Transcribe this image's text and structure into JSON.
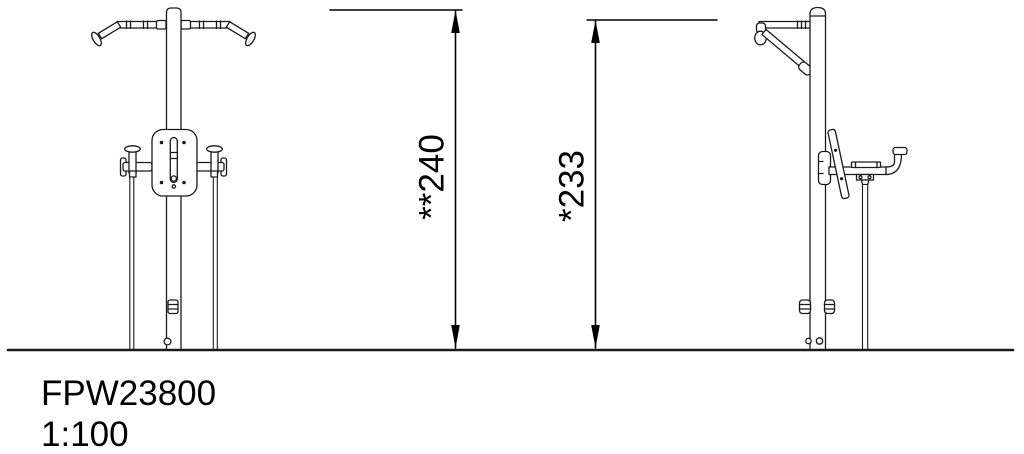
{
  "drawing": {
    "title_block": {
      "product_code": "FPW23800",
      "scale": "1:100"
    },
    "dimensions": {
      "overall_height_label": "**240",
      "grip_height_label": "*233"
    },
    "views": {
      "front_view": "front elevation of pull-up and dip station",
      "side_view": "side elevation of pull-up and dip station"
    },
    "colors": {
      "line": "#1a1a1a",
      "dimension_line": "#000000",
      "background": "#ffffff"
    }
  }
}
